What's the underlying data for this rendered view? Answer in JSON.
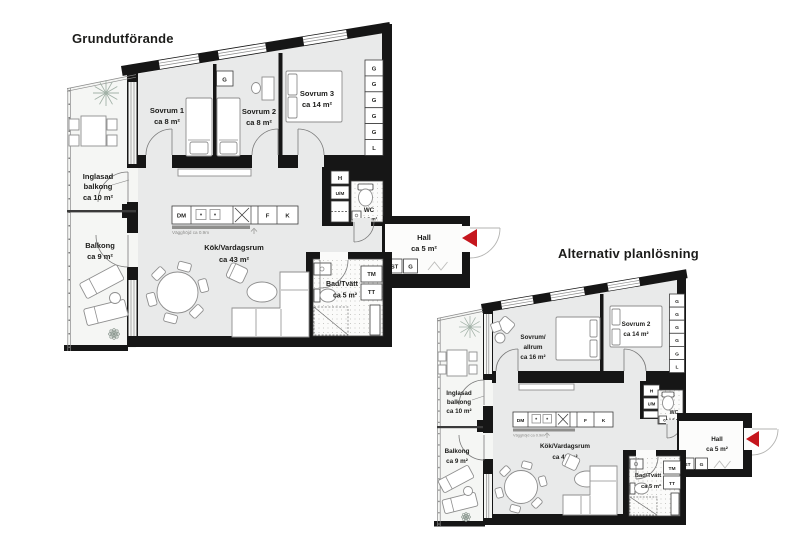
{
  "page": {
    "background": "#ffffff"
  },
  "colors": {
    "wall": "#161616",
    "floor": "#e9eaea",
    "balcony_floor": "#f5f6f4",
    "wet_room_floor": "#fbfbfa",
    "accent_red": "#c5161d",
    "plant": "#a3b2a8"
  },
  "plan1": {
    "title": "Grundutförande",
    "rooms": {
      "sovrum1": {
        "name": "Sovrum 1",
        "area": "ca 8 m²"
      },
      "sovrum2": {
        "name": "Sovrum 2",
        "area": "ca 8 m²"
      },
      "sovrum3": {
        "name": "Sovrum 3",
        "area": "ca 14 m²"
      },
      "inglasad_balkong": {
        "name_line1": "Inglasad",
        "name_line2": "balkong",
        "area": "ca 10 m²"
      },
      "balkong": {
        "name": "Balkong",
        "area": "ca 9 m²"
      },
      "kok_vardagsrum": {
        "name": "Kök/Vardagsrum",
        "area": "ca 43 m²"
      },
      "hall": {
        "name": "Hall",
        "area": "ca 5 m²"
      },
      "bad_tvatt": {
        "name": "Bad/Tvätt",
        "area": "ca 5 m²"
      },
      "wc": {
        "name": "WC",
        "area": "ca 1.5 m²"
      }
    },
    "wardrobe_column": [
      "G",
      "G",
      "G",
      "G",
      "G",
      "L"
    ],
    "fixtures": {
      "bedroom_wardrobe": "G",
      "hat_shelf": "H",
      "um_unit": "U/M",
      "dishwasher": "DM",
      "freezer": "F",
      "fridge": "K",
      "washing_machine": "TM",
      "dryer": "TT",
      "cleaning_closet": "ST",
      "hall_wardrobe": "G"
    },
    "notes": {
      "wall_height": "Vägghöjd ca 0.9m"
    }
  },
  "plan2": {
    "title": "Alternativ planlösning",
    "rooms": {
      "sovrum_allrum": {
        "name_line1": "Sovrum/",
        "name_line2": "allrum",
        "area": "ca 16 m²"
      },
      "sovrum2": {
        "name": "Sovrum 2",
        "area": "ca 14 m²"
      },
      "inglasad_balkong": {
        "name_line1": "Inglasad",
        "name_line2": "balkong",
        "area": "ca 10 m²"
      },
      "balkong": {
        "name": "Balkong",
        "area": "ca 9 m²"
      },
      "kok_vardagsrum": {
        "name": "Kök/Vardagsrum",
        "area": "ca 43 m²"
      },
      "hall": {
        "name": "Hall",
        "area": "ca 5 m²"
      },
      "bad_tvatt": {
        "name": "Bad/Tvätt",
        "area": "ca 5 m²"
      },
      "wc": {
        "name": "WC",
        "area": "ca 1.5 m²"
      }
    },
    "wardrobe_column": [
      "G",
      "G",
      "G",
      "G",
      "G",
      "L"
    ],
    "fixtures": {
      "hat_shelf": "H",
      "um_unit": "U/M",
      "dishwasher": "DM",
      "freezer": "F",
      "fridge": "K",
      "washing_machine": "TM",
      "dryer": "TT",
      "cleaning_closet": "ST",
      "hall_wardrobe": "G"
    },
    "notes": {
      "wall_height": "Vägghöjd ca 0.9m"
    }
  }
}
